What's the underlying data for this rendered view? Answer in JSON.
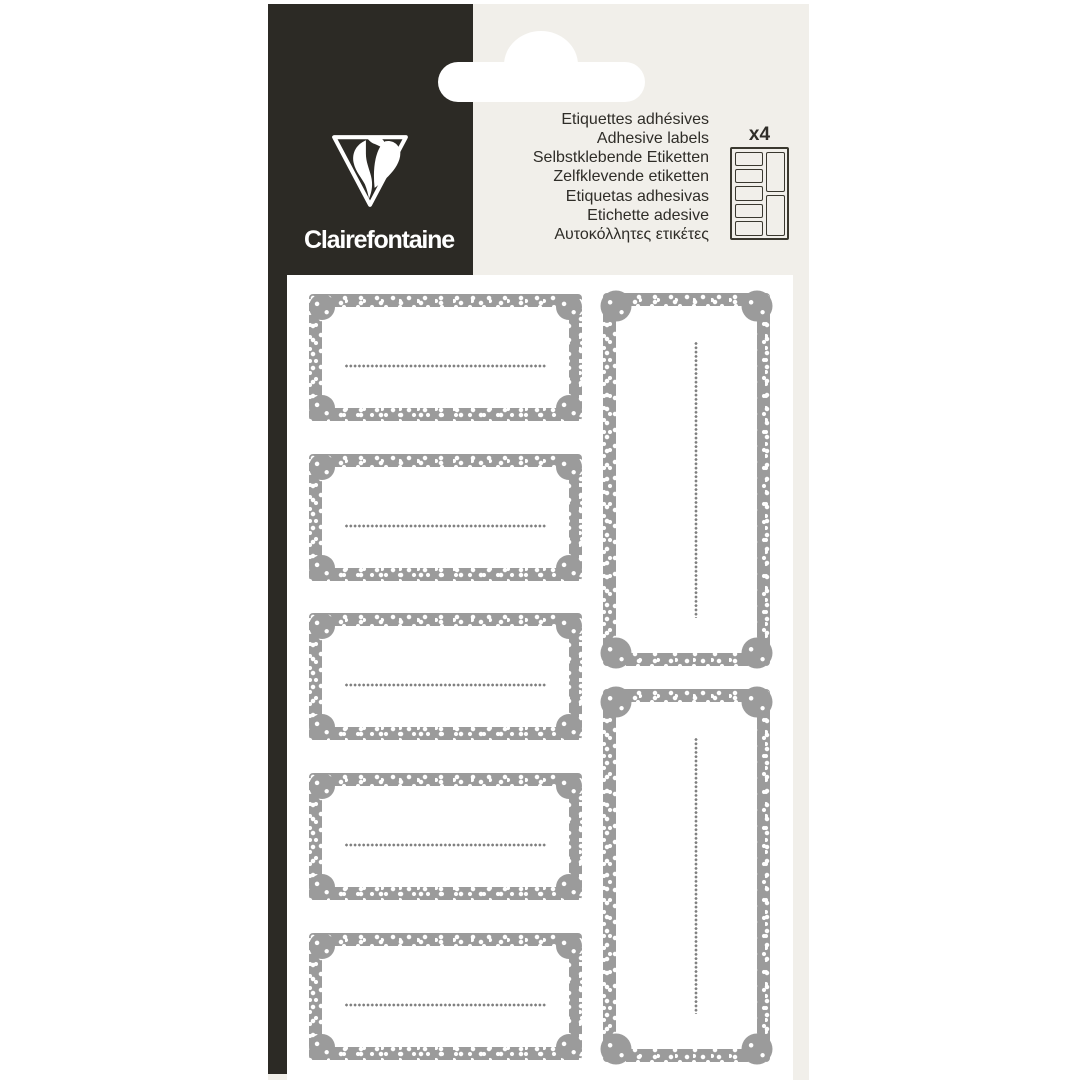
{
  "brand": {
    "name": "Clairefontaine"
  },
  "header": {
    "product_names": [
      "Etiquettes adhésives",
      "Adhesive labels",
      "Selbstklebende Etiketten",
      "Zelfklevende etiketten",
      "Etiquetas adhesivas",
      "Etichette adesive",
      "Αυτοκόλλητες ετικέτες"
    ],
    "sheet_count": "x4"
  },
  "sheet": {
    "horizontal_label_count": 5,
    "vertical_label_count": 2,
    "label_style": "grey polka-dot ticket border, blank white centre, dotted write-on line"
  },
  "colors": {
    "package_black": "#2c2a25",
    "package_cream": "#f1efea",
    "sheet_white": "#ffffff",
    "label_border_grey": "#9b9b9b",
    "write_line_grey": "#7f7f7f",
    "diagram_outline": "#3a382f",
    "text_dark": "#2f2d28"
  }
}
